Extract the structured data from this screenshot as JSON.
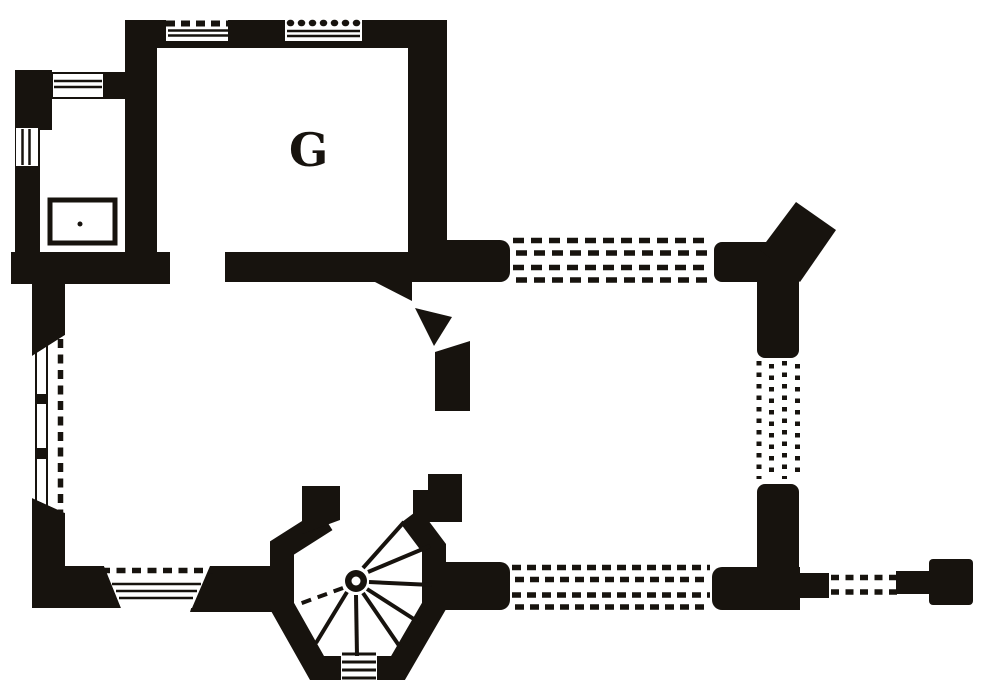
{
  "plan": {
    "room_label": "G",
    "colors": {
      "ink": "#17130e",
      "paper": "#ffffff"
    },
    "features": {
      "labeled_room": "room-G",
      "stair": "spiral-stair-tower",
      "stair_core": "newel-column",
      "windows": "hatched-window-embrasures",
      "dashed_lines": "conjectural-wall-lines",
      "fireplace": "hearth-recess"
    }
  }
}
